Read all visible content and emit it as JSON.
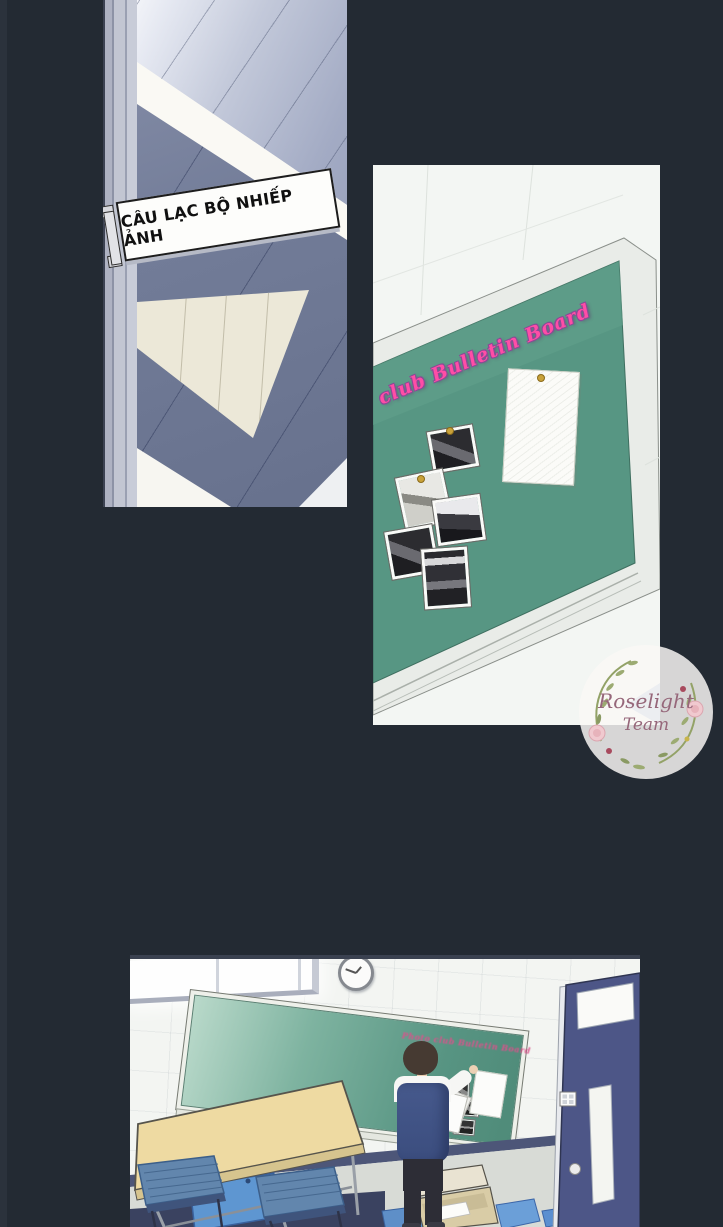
{
  "page": {
    "background_color": "#232a33"
  },
  "panels": {
    "door_hallway": {
      "sign_text": "CÂU LẠC BỘ NHIẾP ẢNH"
    },
    "bulletin_closeup": {
      "board_title": "club Bulletin Board",
      "board_title_color": "#ff4da6",
      "board_green": "#579683",
      "photos_pinned": 5,
      "papers_pinned": 1
    },
    "classroom": {
      "board_caption": "Photo club Bulletin Board",
      "board_caption_color": "#d9538b",
      "photos_pinned": 5,
      "papers_pinned": 1
    }
  },
  "watermark": {
    "line1": "Roselight",
    "line2": "Team",
    "text_color": "#96677a"
  }
}
